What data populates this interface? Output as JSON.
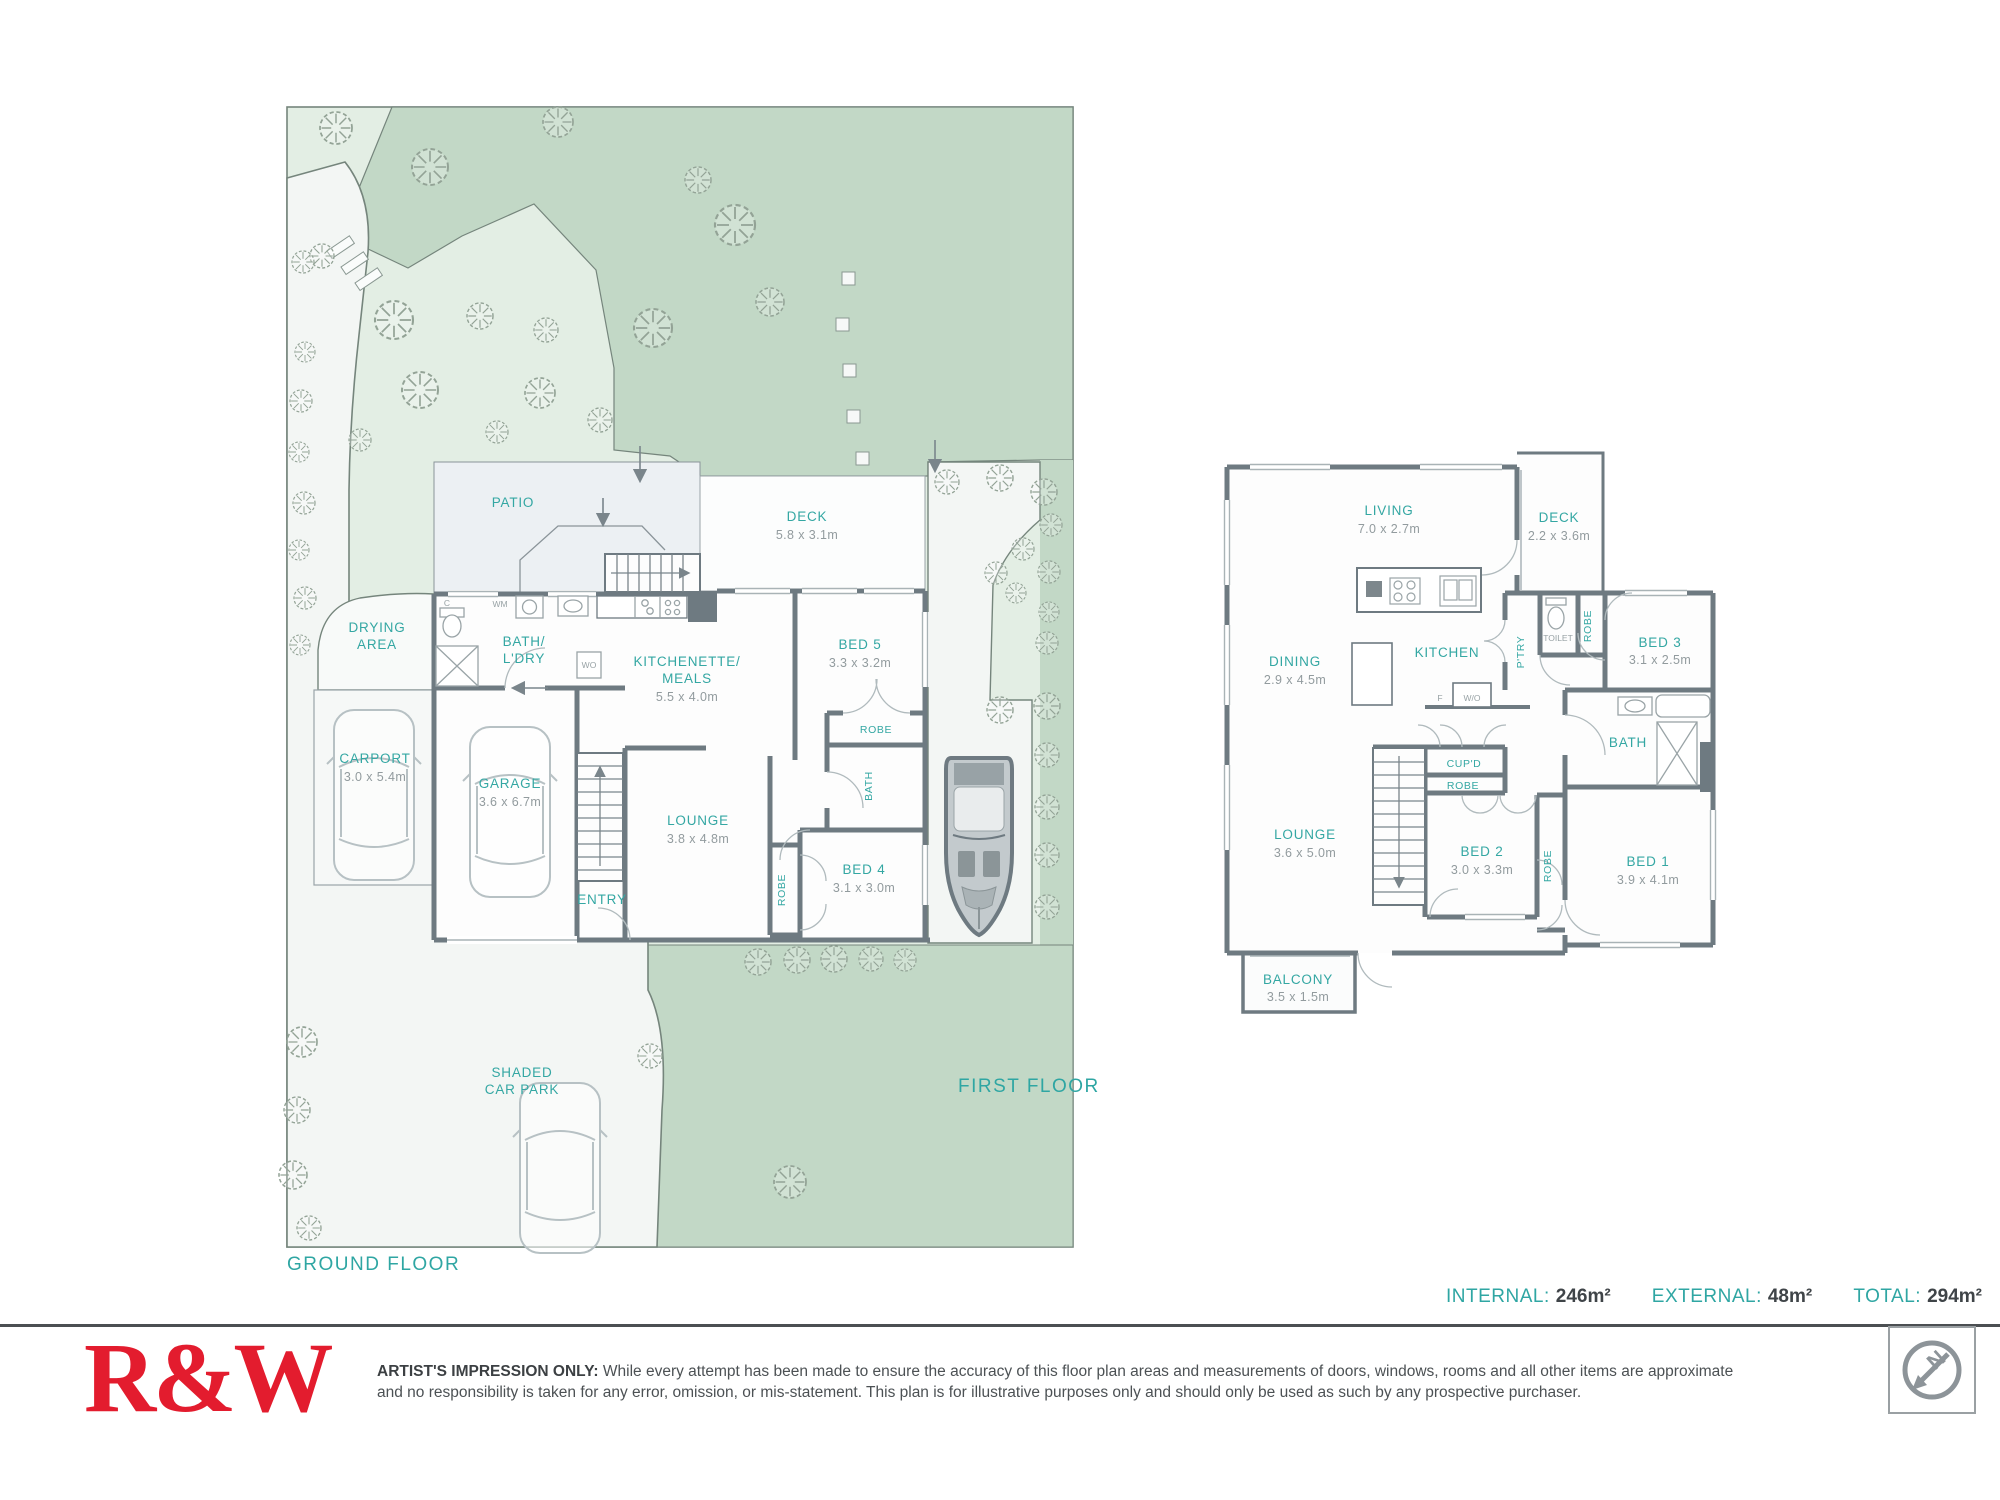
{
  "titles": {
    "ground": "GROUND FLOOR",
    "first": "FIRST FLOOR"
  },
  "ground": {
    "patio": "PATIO",
    "deck_name": "DECK",
    "deck_dims": "5.8 x 3.1m",
    "drying_1": "DRYING",
    "drying_2": "AREA",
    "bath_1": "BATH/",
    "bath_2": "L'DRY",
    "kitchenette_1": "KITCHENETTE/",
    "kitchenette_2": "MEALS",
    "kitchenette_dims": "5.5 x 4.0m",
    "bed5_name": "BED 5",
    "bed5_dims": "3.3 x 3.2m",
    "robe_bed5": "ROBE",
    "bath_small": "BATH",
    "carport_name": "CARPORT",
    "carport_dims": "3.0 x 5.4m",
    "garage_name": "GARAGE",
    "garage_dims": "3.6 x 6.7m",
    "lounge_name": "LOUNGE",
    "lounge_dims": "3.8 x 4.8m",
    "robe_bed4": "ROBE",
    "bed4_name": "BED 4",
    "bed4_dims": "3.1 x 3.0m",
    "entry": "ENTRY",
    "shaded_1": "SHADED",
    "shaded_2": "CAR PARK",
    "wm": "WM",
    "c": "C",
    "wo": "WO"
  },
  "first": {
    "living_name": "LIVING",
    "living_dims": "7.0 x 2.7m",
    "deck_name": "DECK",
    "deck_dims": "2.2 x 3.6m",
    "dining_name": "DINING",
    "dining_dims": "2.9 x 4.5m",
    "kitchen": "KITCHEN",
    "ptry": "P'TRY",
    "toilet": "TOILET",
    "robe_toilet": "ROBE",
    "bed3_name": "BED 3",
    "bed3_dims": "3.1 x 2.5m",
    "f": "F",
    "wo": "W/O",
    "cupd": "CUP'D",
    "robe_hall": "ROBE",
    "lounge_name": "LOUNGE",
    "lounge_dims": "3.6 x 5.0m",
    "bed2_name": "BED 2",
    "bed2_dims": "3.0 x 3.3m",
    "robe_bed1": "ROBE",
    "bath": "BATH",
    "bed1_name": "BED 1",
    "bed1_dims": "3.9 x 4.1m",
    "balcony_name": "BALCONY",
    "balcony_dims": "3.5 x 1.5m"
  },
  "totals": {
    "internal_label": "INTERNAL:",
    "internal_value": "246m²",
    "external_label": "EXTERNAL:",
    "external_value": "48m²",
    "total_label": "TOTAL:",
    "total_value": "294m²"
  },
  "footer": {
    "logo": "R&W",
    "disclaimer_lead": "ARTIST'S IMPRESSION ONLY:",
    "disclaimer_body": " While every attempt has been made to ensure the accuracy of this floor plan areas and measurements of doors, windows, rooms and all other items are approximate and no responsibility is taken for any error, omission, or mis-statement. This plan is for illustrative purposes only and should only be used as such by any prospective purchaser.",
    "compass_letter": "N"
  }
}
